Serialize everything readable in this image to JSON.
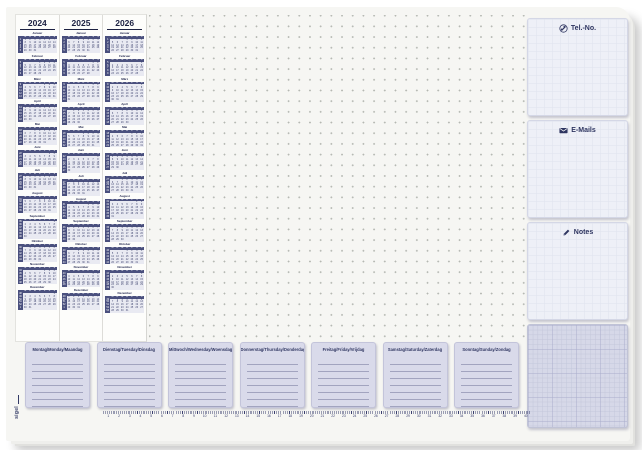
{
  "product": {
    "brand": "sigel"
  },
  "calendar": {
    "years": [
      "2024",
      "2025",
      "2026"
    ],
    "month_names": [
      "Januar",
      "Februar",
      "März",
      "April",
      "Mai",
      "Juni",
      "Juli",
      "August",
      "September",
      "Oktober",
      "November",
      "Dezember"
    ],
    "weekday_initials": [
      "M",
      "D",
      "M",
      "D",
      "F",
      "S",
      "S"
    ]
  },
  "sidebar": {
    "sections": [
      {
        "id": "tel",
        "icon": "phone-icon",
        "label": "Tel.-No."
      },
      {
        "id": "emails",
        "icon": "email-icon",
        "label": "E-Mails"
      },
      {
        "id": "notes",
        "icon": "pencil-icon",
        "label": "Notes"
      }
    ]
  },
  "week_planner": {
    "days": [
      "Montag/Monday/Maandag",
      "Dienstag/Tuesday/Dinsdag",
      "Mittwoch/Wednesday/Woensdag",
      "Donnerstag/Thursday/Donderdag",
      "Freitag/Friday/Vrijdag",
      "Samstag/Saturday/Zaterdag",
      "Sonntag/Sunday/Zondag"
    ],
    "lines_per_day": 7
  },
  "ruler": {
    "start": 1,
    "end": 40
  },
  "colors": {
    "navy": "#2e3560",
    "lavender": "#d9daea",
    "card_grid": "#eef0f7",
    "graph": "#d6d8e8"
  }
}
